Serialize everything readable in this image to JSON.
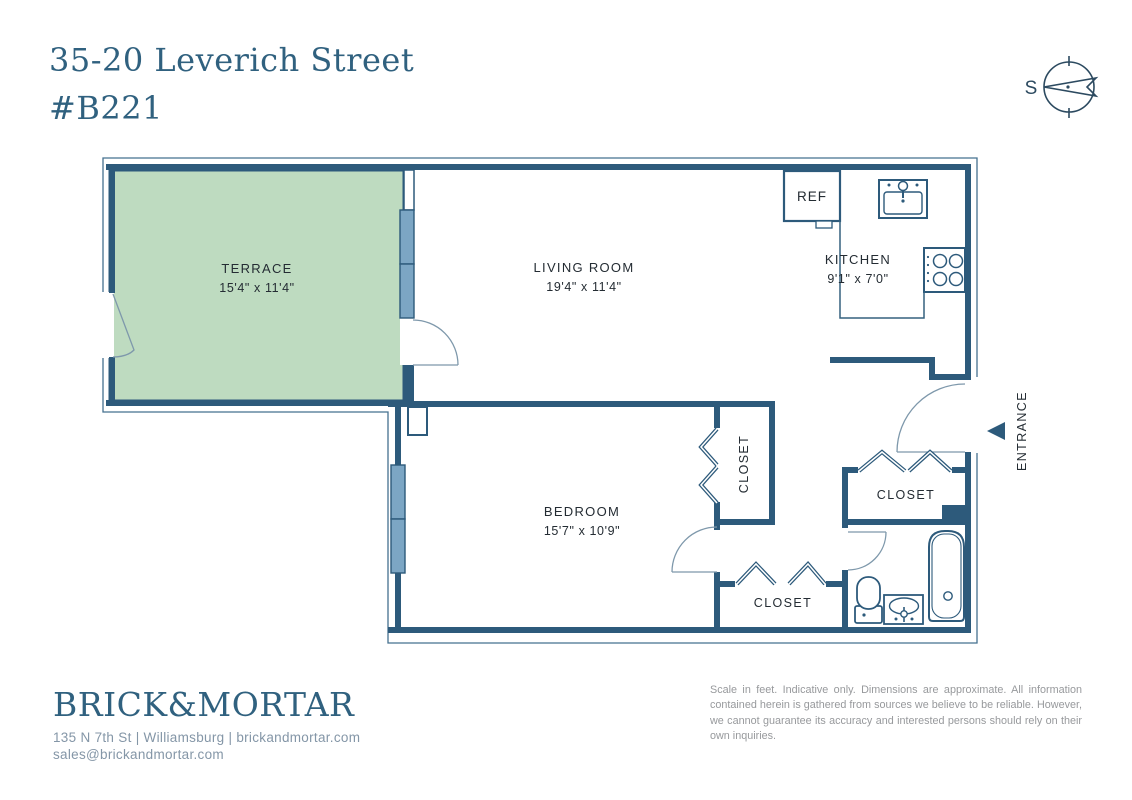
{
  "header": {
    "address_line1": "35-20 Leverich Street",
    "address_line2": "#B221"
  },
  "compass": {
    "south_label": "S"
  },
  "floorplan": {
    "rooms": {
      "terrace": {
        "name": "TERRACE",
        "dims": "15'4\" x 11'4\""
      },
      "living_room": {
        "name": "LIVING ROOM",
        "dims": "19'4\" x 11'4\""
      },
      "kitchen": {
        "name": "KITCHEN",
        "dims": "9'1\" x 7'0\""
      },
      "bedroom": {
        "name": "BEDROOM",
        "dims": "15'7\" x 10'9\""
      }
    },
    "labels": {
      "ref": "REF",
      "entrance": "ENTRANCE",
      "closet_bedroom": "CLOSET",
      "closet_hall": "CLOSET",
      "closet_lower": "CLOSET"
    },
    "colors": {
      "wall": "#2d5a7b",
      "window_fill": "#7ca6c4",
      "terrace_fill": "#bedbc0",
      "accent_text": "#30617f"
    }
  },
  "footer": {
    "brand": "BRICK&MORTAR",
    "contact_line": "135 N 7th St | Williamsburg | brickandmortar.com",
    "email": "sales@brickandmortar.com",
    "disclaimer": "Scale in feet. Indicative only. Dimensions are approximate. All information contained herein is gathered from sources we believe to be reliable. However, we cannot guarantee its accuracy and interested persons should rely on their own inquiries."
  }
}
